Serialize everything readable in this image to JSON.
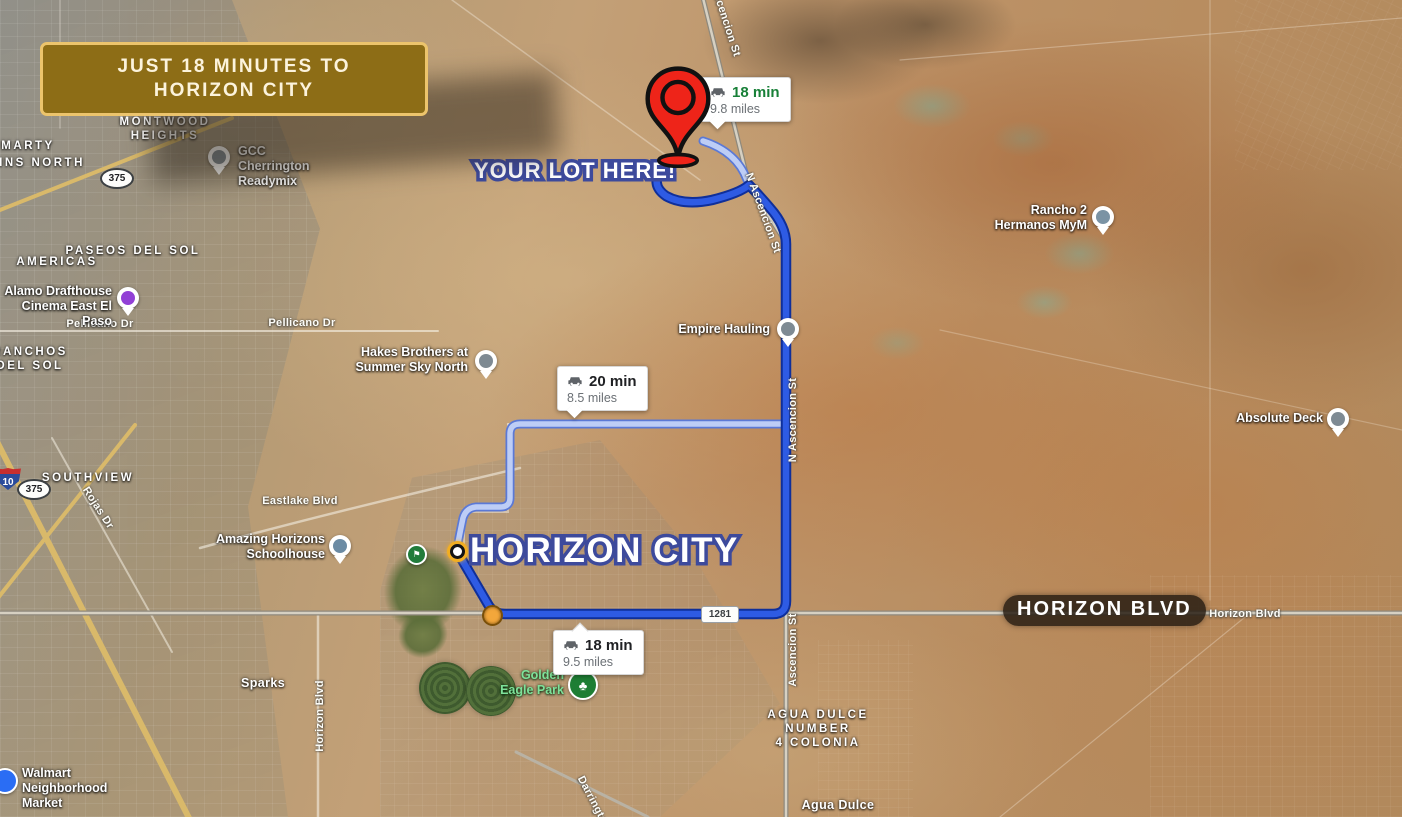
{
  "banner": {
    "line1": "JUST 18 MINUTES TO",
    "line2": "HORIZON CITY"
  },
  "callouts": {
    "your_lot": "YOUR LOT HERE!",
    "horizon_city": "HORIZON CITY",
    "horizon_blvd": "HORIZON BLVD"
  },
  "badges": [
    {
      "time": "18 min",
      "distance": "9.8 miles"
    },
    {
      "time": "20 min",
      "distance": "8.5 miles"
    },
    {
      "time": "18 min",
      "distance": "9.5 miles"
    }
  ],
  "pois": [
    {
      "name": "GCC Cherrington\nReadymix"
    },
    {
      "name": "Alamo Drafthouse\nCinema East El Paso"
    },
    {
      "name": "Hakes Brothers at\nSummer Sky North"
    },
    {
      "name": "Empire Hauling"
    },
    {
      "name": "Rancho 2\nHermanos MyM"
    },
    {
      "name": "Absolute Deck"
    },
    {
      "name": "Amazing Horizons\nSchoolhouse"
    },
    {
      "name": "Golden\nEagle Park"
    },
    {
      "name": "Walmart\nNeighborhood Market"
    }
  ],
  "areas": [
    {
      "text": "MARTY"
    },
    {
      "text": "INS NORTH"
    },
    {
      "text": "MONTWOOD\nHEIGHTS"
    },
    {
      "text": "AMERICAS"
    },
    {
      "text": "PASEOS DEL SOL"
    },
    {
      "text": "RANCHOS\nDEL SOL"
    },
    {
      "text": "SOUTHVIEW"
    },
    {
      "text": "Sparks"
    },
    {
      "text": "AGUA DULCE\nNUMBER\n4 COLONIA"
    },
    {
      "text": "Agua Dulce"
    }
  ],
  "roads": [
    {
      "text": "Pellicano Dr"
    },
    {
      "text": "Pellicano Dr"
    },
    {
      "text": "Eastlake Blvd"
    },
    {
      "text": "Rojas Dr"
    },
    {
      "text": "Horizon Blvd"
    },
    {
      "text": "Horizon Blvd"
    },
    {
      "text": "N Ascencion St"
    },
    {
      "text": "N Ascencion St"
    },
    {
      "text": "Ascencion St"
    },
    {
      "text": "Darrington"
    },
    {
      "text": "N Ascencion St"
    }
  ],
  "shields": {
    "loop": "375",
    "interstate": "10",
    "farm": "1281"
  },
  "colors": {
    "route_main": "#2e5be4",
    "route_main_border": "#0f2f9a",
    "route_alt": "#bdcdf6",
    "route_alt_border": "#5b79d6",
    "badge_time_green": "#188038",
    "banner_bg": "#8d6d16",
    "banner_border": "#ecc46c",
    "callout_outline": "#3d4a9c",
    "pin_red": "#ee2419"
  }
}
